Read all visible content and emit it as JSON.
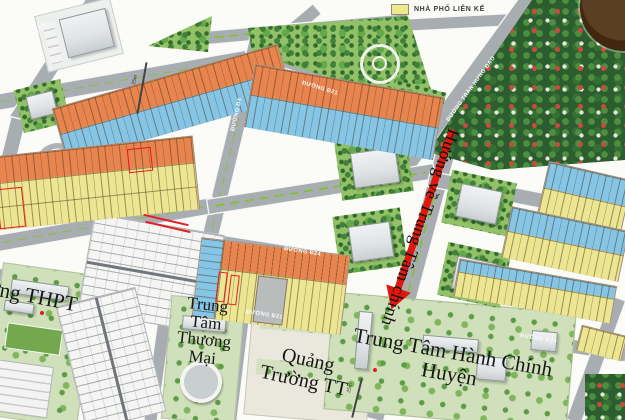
{
  "legend": {
    "items": [
      {
        "label": "NHÀ PHỐ LIÊN KẾ",
        "color": "#efe88d"
      }
    ]
  },
  "roads": {
    "d2": "ĐƯỜNG D2",
    "d4": "ĐƯỜNG D4",
    "d21_top": "ĐƯỜNG Đ21",
    "d24_mid": "ĐƯỜNG Đ24",
    "d21_bottom": "ĐƯỜNG Đ21",
    "d24_right": "ĐƯỜNG Đ24",
    "tran_hung_dao": "ĐƯỜNG TRẦN HƯNG ĐẠO"
  },
  "places": {
    "school": "Trường THPT",
    "mall": "Trung Tâm Thương Mại",
    "square": "Quảng Trường TT",
    "admin_center": "Trung Tâm Hành Chính Huyện"
  },
  "arrow": {
    "label": "Hướng về Trung Tâm chính",
    "color": "#e0180c"
  },
  "dimensions": [
    "25m",
    "25m"
  ],
  "plot_bands": [
    {
      "id": "A",
      "rows": [
        "orange",
        "blue"
      ],
      "area": "top-left"
    },
    {
      "id": "B",
      "rows": [
        "orange",
        "yellow"
      ],
      "area": "left",
      "red_highlights": 2
    },
    {
      "id": "C",
      "rows": [
        "orange",
        "blue"
      ],
      "area": "center"
    },
    {
      "id": "E1",
      "rows": [
        "blue",
        "yellow"
      ],
      "area": "right-upper"
    },
    {
      "id": "E2",
      "rows": [
        "blue",
        "yellow"
      ],
      "area": "right-middle"
    },
    {
      "id": "G",
      "rows": [
        "blue",
        "yellow"
      ],
      "area": "bottom-right"
    },
    {
      "id": "F",
      "rows": [
        "blue",
        "orange",
        "yellow",
        "gray"
      ],
      "area": "bottom-center",
      "red_highlights": 2
    }
  ],
  "colors": {
    "plot_orange": "#e8854e",
    "plot_blue": "#85c6e6",
    "plot_yellow": "#ece692",
    "road_gray": "#a8adb2",
    "park_green": "#93c167",
    "village_green": "#2b5d2e",
    "highlight_red": "#e81a22",
    "arrow_red": "#e0180c",
    "logo_brown": "#4a3118"
  }
}
